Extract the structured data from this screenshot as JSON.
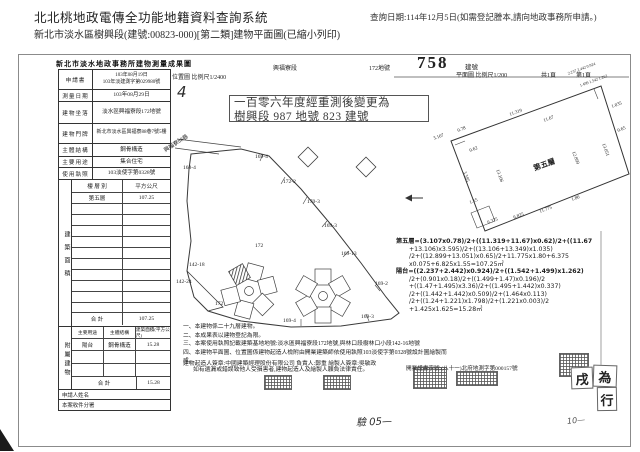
{
  "page": {
    "system_title": "北北桃地政電傳全功能地籍資料查詢系統",
    "query_date": "查詢日期:114年12月5日(如需登記謄本,請向地政事務所申請。)",
    "subtitle": "新北市淡水區樹興段(建號:00823-000)[第二類]建物平面圖(已縮小列印)"
  },
  "form": {
    "title": "新北市淡水地政事務所建物測量成果圖",
    "application_label": "申請書",
    "application_date": "103年08月19日",
    "application_no": "103年淡建測字第029980號",
    "survey_date_label": "測量日期",
    "survey_date": "103年08月29日",
    "site_label": "建物坐落",
    "site": "淡水區興福寮段172地號",
    "door_label": "建物門牌",
    "door": "新北市淡水區興福寮88巷7號5樓",
    "structure_label": "主體結構",
    "structure": "鋼骨構造",
    "use_label": "主要用途",
    "use": "集合住宅",
    "license_label": "使用執照",
    "license": "103淡使字第0328號",
    "floor_section_label": "建築面積",
    "floor_col1": "樓 層 別",
    "floor_col2": "平方公尺",
    "floor_name": "第五層",
    "floor_area": "107.25",
    "total_label": "合  計",
    "floor_total": "107.25",
    "annex_section_label": "附屬建物",
    "annex_col1": "主要用途",
    "annex_col2": "主體結構",
    "annex_col3": "建築面積(平方公尺)",
    "annex_use": "陽台",
    "annex_structure": "鋼骨構造",
    "annex_area": "15.28",
    "annex_total": "15.28",
    "applicant_label": "申請人姓名",
    "office_label": "本案收件分署"
  },
  "site_map": {
    "caption": "位置圖 比例尺1/2400",
    "hand_mark": "4",
    "section_name": "興福寮段",
    "lot_no": "172地號",
    "road": "興福寮88巷",
    "remark1": "一百零六年度經重測後變更為",
    "remark2": "樹興段 987 地號 823 建號",
    "parcels": {
      "a": "169-4",
      "b": "172-2",
      "c": "170-3",
      "d": "169-3",
      "e": "169-13",
      "f": "142-18",
      "g": "142-24",
      "h": "172",
      "i": "172",
      "j": "169-2",
      "k": "169-3",
      "l": "169-4",
      "m": "168-4"
    }
  },
  "floor_plan": {
    "build_no": "758",
    "build_no_label": "建號",
    "caption": "平面圖 比例尺1/200",
    "pages": "共1頁",
    "page": "第1頁",
    "room": "第五層",
    "dims": {
      "d1": "11.319",
      "d2": "11.67",
      "d3": "0.62",
      "d4": "3.595",
      "d5": "13.106",
      "d6": "12.899",
      "d7": "13.051",
      "d8": "1.035",
      "d9": "11.775",
      "d10": "6.375",
      "d11": "6.825",
      "d12": "1.55",
      "d13": "3.107",
      "d14": "0.78",
      "d15": "0.65",
      "d16": "1.80",
      "cluster1": "2.237 2.442 0.924",
      "cluster2": "1.499 1.542 1.262"
    }
  },
  "calc": {
    "lines": [
      "第五層=(3.107x0.78)/2+((11.319+11.67)x0.62)/2+((11.67",
      "+13.106)x3.595)/2+((13.106+13.349)x1.035)",
      "/2+((12.899+13.051)x0.65)/2+11.775x1.80+6.375",
      "x0.075+6.825x1.55=107.25㎡",
      "陽台=((2.237+2.442)x0.924)/2+((1.542+1.499)x1.262)",
      "/2+(0.901x0.18)/2+((1.499+1.47)x0.196)/2",
      "+((1.47+1.495)x3.36)/2+((1.495+1.442)x0.337)",
      "/2+((1.442+1.442)x0.509)/2+(1.464x0.113)",
      "/2+((1.24+1.221)x1.798)/2+(1.221x0.003)/2",
      "+1.425x1.625=15.28㎡"
    ]
  },
  "notes": {
    "lines": [
      "一、本建物係二十九層建物。",
      "二、本成果表以建物登記為限。",
      "三、本案使用執照記載建築基地地號:淡水區興福寮段172地號,與林口段樹林口小段142-16地號",
      "四、本建物平面圖、位置圖係建物起造人檢附由開業建築師依使用執照103淡使字第0328號設計圖繪製而成,",
      "如有遺漏或錯誤致他人受損害者,建物起造人及繪製人願負法律責任。"
    ],
    "signature": "建物起造人簽章:中國建築經理股份有限公司  負責人:鄭重  繪製人簽章:吳敏政",
    "license_no": "開業證書字號:(八十一)北府地測字第000157號"
  },
  "annot": {
    "seal_chars": [
      "戌",
      "為",
      "行"
    ],
    "hand1": "驗 05—",
    "hand2": "10—"
  }
}
